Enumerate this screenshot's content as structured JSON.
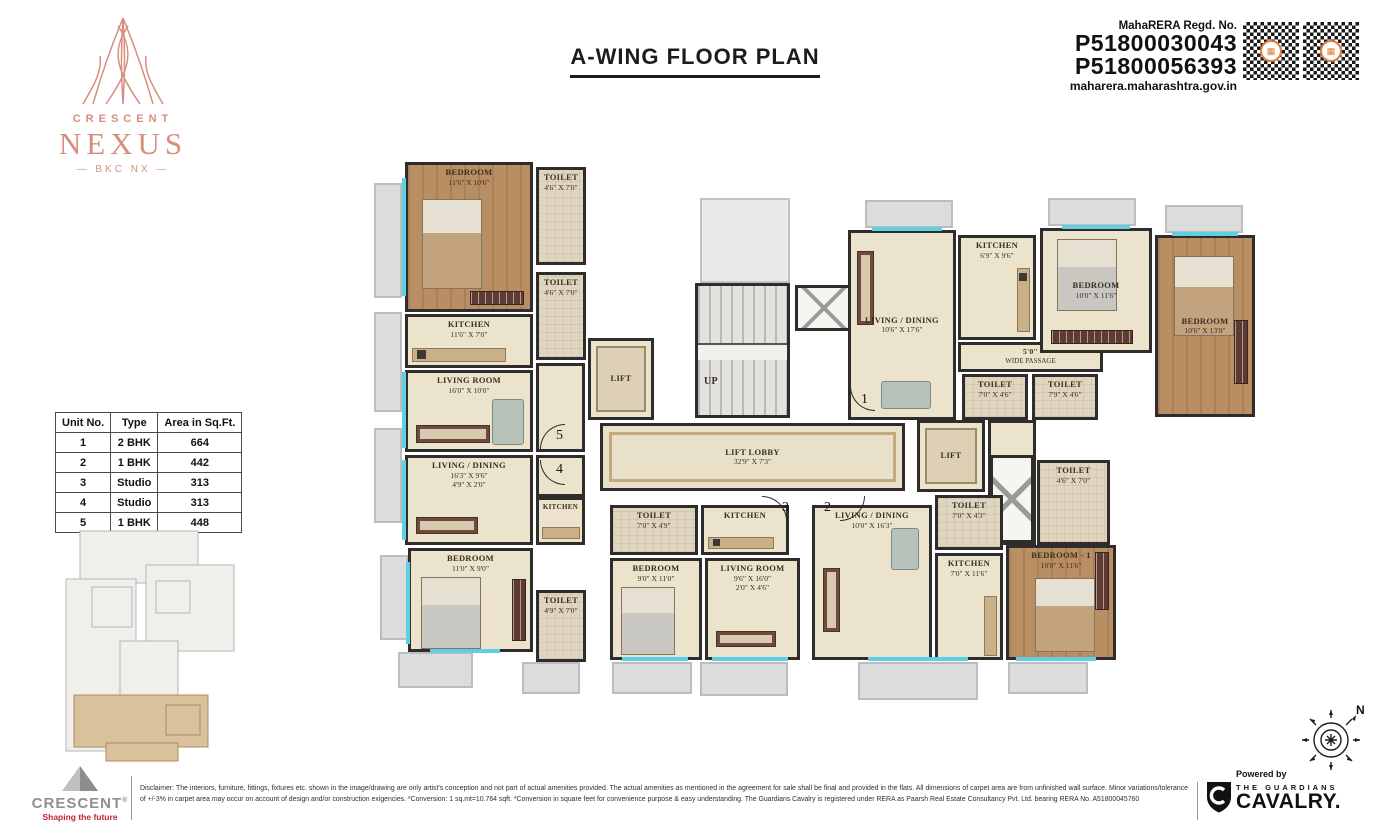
{
  "brand": {
    "crescent": "CRESCENT",
    "nexus": "NEXUS",
    "bkc": "— BKC NX —"
  },
  "header": {
    "title": "A-WING FLOOR PLAN"
  },
  "rera": {
    "label": "MahaRERA Regd. No.",
    "no1": "P51800030043",
    "no2": "P51800056393",
    "site": "maharera.maharashtra.gov.in"
  },
  "unit_table": {
    "headers": [
      "Unit No.",
      "Type",
      "Area in Sq.Ft."
    ],
    "rows": [
      [
        "1",
        "2 BHK",
        "664"
      ],
      [
        "2",
        "1 BHK",
        "442"
      ],
      [
        "3",
        "Studio",
        "313"
      ],
      [
        "4",
        "Studio",
        "313"
      ],
      [
        "5",
        "1 BHK",
        "448"
      ]
    ]
  },
  "plan": {
    "rooms": [
      {
        "name": "BEDROOM",
        "dims": "11'6\" X 10'6\""
      },
      {
        "name": "TOILET",
        "dims": "4'6\" X 7'0\""
      },
      {
        "name": "TOILET",
        "dims": "4'6\" X 7'0\""
      },
      {
        "name": "KITCHEN",
        "dims": "11'6\" X 7'0\""
      },
      {
        "name": "LIVING ROOM",
        "dims": "16'0\" X 10'0\""
      },
      {
        "name": "LIVING / DINING",
        "dims": "16'3\" X 9'6\"",
        "dims2": "4'9\" X 2'0\""
      },
      {
        "name": "KITCHEN"
      },
      {
        "name": "BEDROOM",
        "dims": "11'0\" X 9'0\""
      },
      {
        "name": "TOILET",
        "dims": "4'9\" X 7'0\""
      },
      {
        "name": "TOILET",
        "dims": "7'0\" X 4'9\""
      },
      {
        "name": "BEDROOM",
        "dims": "9'0\" X 11'0\""
      },
      {
        "name": "KITCHEN"
      },
      {
        "name": "LIVING ROOM",
        "dims": "9'6\" X 16'0\"",
        "dims2": "2'0\" X 4'6\""
      },
      {
        "name": "LIVING / DINING",
        "dims": "10'0\" X 16'3\""
      },
      {
        "name": "TOILET",
        "dims": "7'0\" X 4'3\""
      },
      {
        "name": "KITCHEN",
        "dims": "7'0\" X 11'6\""
      },
      {
        "name": "BEDROOM - 1",
        "dims": "10'0\" X 11'6\""
      },
      {
        "name": "TOILET",
        "dims": "4'6\" X 7'0\""
      },
      {
        "name": "LIVING / DINING",
        "dims": "10'6\" X 17'6\""
      },
      {
        "name": "KITCHEN",
        "dims": "6'9\" X 9'6\""
      },
      {
        "name": "5'0\"",
        "dims": "WIDE PASSAGE"
      },
      {
        "name": "TOILET",
        "dims": "7'0\" X 4'6\""
      },
      {
        "name": "TOILET",
        "dims": "7'9\" X 4'6\""
      },
      {
        "name": "BEDROOM",
        "dims": "10'0\" X 11'6\""
      },
      {
        "name": "BEDROOM",
        "dims": "10'6\" X 13'0\""
      },
      {
        "name": "LIFT"
      },
      {
        "name": "LIFT"
      },
      {
        "name": "LIFT LOBBY",
        "dims": "32'9\" X 7'3\""
      },
      {
        "name": "UP"
      }
    ],
    "units": [
      "1",
      "2",
      "3",
      "4",
      "5"
    ]
  },
  "compass": {
    "north": "N"
  },
  "footer": {
    "disclaimer": "Disclaimer: The interiors, furniture, fittings, fixtures etc. shown in the image/drawing are only artist's conception and not part of actual amenities provided. The actual amenities as mentioned in the agreement for sale shall be final and provided in the flats. All dimensions of carpet area are from unfinished wall surface. Minor variations/tolerance of +/-3% in carpet area may occur on account of design and/or construction exigencies. *Conversion: 1 sq.mt=10.764 sqft. *Conversion in square feet for convenience purpose & easy understanding. The Guardians Cavalry is registered under RERA as Paarsh Real Estate Consultancy Pvt. Ltd. bearing RERA No. A51800045760",
    "crescent": "CRESCENT",
    "reg": "®",
    "tagline": "Shaping the future",
    "powered_by": "Powered by",
    "guardians": "THE GUARDIANS",
    "cavalry": "CAVALRY."
  },
  "colors": {
    "brand_salmon": "#d88d7f",
    "wall": "#2e2d2b",
    "floor_cream": "#ece3cc",
    "floor_wood": "#b98e63",
    "window_cyan": "#5fd0e4",
    "qr_accent": "#e07b39",
    "tagline_red": "#c0272d"
  }
}
